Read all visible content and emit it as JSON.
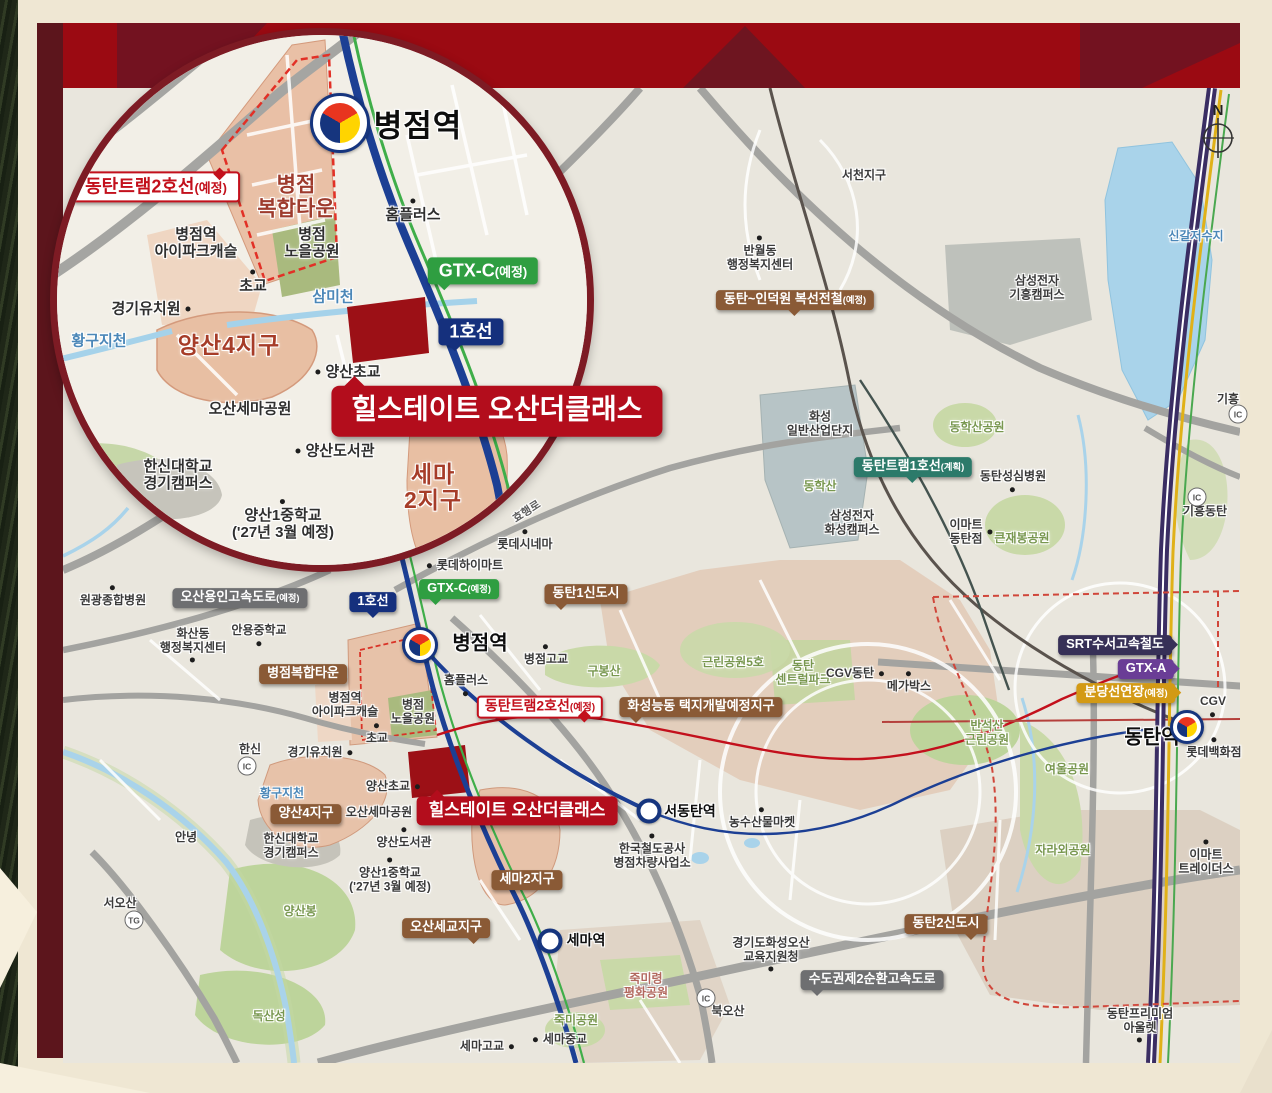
{
  "compass": {
    "north_label": "N"
  },
  "colors": {
    "frame_top": "#9b0a12",
    "frame_left": "#5c151c",
    "margin": "#efe7d3",
    "accent_red": "#b30d1c",
    "line_rail1": "#1c3f94",
    "line_gtxc": "#3fae49",
    "line_srt_gtxa": "#3a2d63",
    "line_bundang": "#e0b118",
    "line_tram2": "#c3101c",
    "badge_brown": "#8a5a36",
    "badge_gray": "#6e6f71",
    "district_salmon": "#e7c2a9",
    "park_green": "#c9d9a8",
    "water_blue": "#a9d3ea",
    "site_red": "#9c1016"
  },
  "callouts": [
    {
      "name": "project-callout-inset",
      "text": "힐스테이트 오산더클래스",
      "type": "callout-red lg",
      "x": 497,
      "y": 411,
      "tail": "tl"
    }
  ],
  "inset": {
    "stations": [
      {
        "name": "byeongjeom-station-symbol-inset",
        "kind": "taegeuk",
        "x": 283,
        "y": 88,
        "size": 54
      }
    ],
    "labels": [
      {
        "name": "station-label-byeongjeom-inset",
        "text": "병점역",
        "type": "station-big",
        "x": 361,
        "y": 91
      },
      {
        "name": "tram2-line-badge-inset",
        "text": "동탄트램2호선",
        "sub": "(예정)",
        "type": "badge-red-outline lg",
        "x": 99,
        "y": 152,
        "tail": "tr"
      },
      {
        "name": "district-byeongjeom-mixed-town",
        "text": "병점\n복합타운",
        "type": "district-text",
        "x": 239,
        "y": 162
      },
      {
        "name": "place-ipark-castle-inset",
        "text": "병점역\n아이파크캐슬",
        "type": "place lg",
        "x": 139,
        "y": 209
      },
      {
        "name": "place-noeul-park-inset",
        "text": "병점\n노을공원",
        "type": "place lg",
        "x": 255,
        "y": 209
      },
      {
        "name": "place-homeplus-inset",
        "text": "홈플러스",
        "type": "place lg",
        "x": 356,
        "y": 181,
        "dot": "t"
      },
      {
        "name": "place-chogyo-inset",
        "text": "초교",
        "type": "place lg",
        "x": 196,
        "y": 252,
        "dot": "t"
      },
      {
        "name": "water-sammicheon-inset",
        "text": "삼미천",
        "type": "water lg",
        "x": 276,
        "y": 263
      },
      {
        "name": "gtxc-badge-inset",
        "text": "GTX-C",
        "sub": "(예정)",
        "type": "badge-green lg",
        "x": 426,
        "y": 236,
        "tail": "bl"
      },
      {
        "name": "line1-badge-inset",
        "text": "1호선",
        "type": "badge-navy lg",
        "x": 414,
        "y": 297,
        "tail": "bl"
      },
      {
        "name": "place-kindergarten-inset",
        "text": "경기유치원",
        "type": "place lg",
        "x": 89,
        "y": 275,
        "dot": "r"
      },
      {
        "name": "water-hwangguji-inset",
        "text": "황구지천",
        "type": "water lg",
        "x": 42,
        "y": 307
      },
      {
        "name": "district-yangsan4-inset",
        "text": "양산4지구",
        "type": "district-big",
        "x": 172,
        "y": 310
      },
      {
        "name": "place-yangsan-elementary-inset",
        "text": "양산초교",
        "type": "place lg",
        "x": 296,
        "y": 338,
        "dot": "l"
      },
      {
        "name": "place-osan-sema-park-inset",
        "text": "오산세마공원",
        "type": "place lg",
        "x": 193,
        "y": 375
      },
      {
        "name": "place-yangsan-library-inset",
        "text": "양산도서관",
        "type": "place lg",
        "x": 283,
        "y": 417,
        "dot": "l"
      },
      {
        "name": "district-sema2-inset",
        "text": "세마\n2지구",
        "type": "district-big",
        "x": 376,
        "y": 452
      },
      {
        "name": "place-hanshin-univ-inset",
        "text": "한신대학교\n경기캠퍼스",
        "type": "place lg",
        "x": 121,
        "y": 441
      },
      {
        "name": "place-namsuwon-inset",
        "text": "남수원\n체력단련장",
        "type": "dim",
        "x": 40,
        "y": 504
      },
      {
        "name": "place-yangsan1-middle-inset",
        "text": "양산1중학교\n('27년 3월 예정)",
        "type": "place lg",
        "x": 226,
        "y": 490,
        "dot": "t"
      }
    ]
  },
  "main": {
    "stations": [
      {
        "name": "byeongjeom-station-symbol",
        "kind": "taegeuk",
        "x": 420,
        "y": 645,
        "size": 30
      },
      {
        "name": "dongtan-station-symbol",
        "kind": "taegeuk",
        "x": 1187,
        "y": 727,
        "size": 28
      },
      {
        "name": "seodongtan-station-symbol",
        "kind": "ring",
        "x": 649,
        "y": 811,
        "size": 17
      },
      {
        "name": "sema-station-symbol",
        "kind": "ring",
        "x": 550,
        "y": 941,
        "size": 17
      }
    ],
    "markers": [
      {
        "name": "ic-giheung",
        "text": "IC",
        "x": 1238,
        "y": 414
      },
      {
        "name": "ic-giheung-dongtan",
        "text": "IC",
        "x": 1197,
        "y": 497
      },
      {
        "name": "ic-hanshin",
        "text": "IC",
        "x": 247,
        "y": 766
      },
      {
        "name": "tg-seoosan",
        "text": "TG",
        "x": 134,
        "y": 920
      },
      {
        "name": "ic-bukosan",
        "text": "IC",
        "x": 706,
        "y": 998
      }
    ],
    "labels": [
      {
        "name": "place-seocheon-district",
        "text": "서천지구",
        "type": "place",
        "x": 864,
        "y": 176
      },
      {
        "name": "place-banwol-center",
        "text": "반월동\n행정복지센터",
        "type": "place",
        "x": 760,
        "y": 258,
        "dot": "t"
      },
      {
        "name": "indeogwon-line-badge",
        "text": "동탄~인덕원 복선전철",
        "sub": "(예정)",
        "type": "badge-brown",
        "x": 795,
        "y": 300,
        "tail": "b"
      },
      {
        "name": "place-samsung-giheung",
        "text": "삼성전자\n기흥캠퍼스",
        "type": "place",
        "x": 1037,
        "y": 288
      },
      {
        "name": "water-singal-reservoir",
        "text": "신갈저수지",
        "type": "water",
        "x": 1196,
        "y": 237
      },
      {
        "name": "place-giheung",
        "text": "기흥",
        "type": "place",
        "x": 1228,
        "y": 400
      },
      {
        "name": "place-hwaseong-industrial",
        "text": "화성\n일반산업단지",
        "type": "place",
        "x": 820,
        "y": 424
      },
      {
        "name": "park-donghaksan-park",
        "text": "동학산공원",
        "type": "park",
        "x": 977,
        "y": 428
      },
      {
        "name": "tram1-line-badge",
        "text": "동탄트램1호선",
        "sub": "(계획)",
        "type": "badge-teal",
        "x": 913,
        "y": 467,
        "tail": "b"
      },
      {
        "name": "place-dongtan-hospital",
        "text": "동탄성심병원",
        "type": "place",
        "x": 1013,
        "y": 477,
        "dot": "b"
      },
      {
        "name": "park-donghaksan",
        "text": "동학산",
        "type": "park",
        "x": 820,
        "y": 487
      },
      {
        "name": "place-giheung-dongtan",
        "text": "기흥동탄",
        "type": "place",
        "x": 1205,
        "y": 512
      },
      {
        "name": "place-samsung-hwaseong",
        "text": "삼성전자\n화성캠퍼스",
        "type": "place",
        "x": 852,
        "y": 523
      },
      {
        "name": "place-emart-dongtan",
        "text": "이마트\n동탄점",
        "type": "place",
        "x": 966,
        "y": 532,
        "dot": "r"
      },
      {
        "name": "park-keunjaebong",
        "text": "큰재봉공원",
        "type": "park",
        "x": 1022,
        "y": 539
      },
      {
        "name": "road-hyohaeng-ro",
        "text": "효행로",
        "type": "road-name",
        "x": 527,
        "y": 512,
        "rot": -33
      },
      {
        "name": "place-lotte-cinema",
        "text": "롯데시네마",
        "type": "place",
        "x": 525,
        "y": 545,
        "dot": "t"
      },
      {
        "name": "place-lotte-himart",
        "text": "롯데하이마트",
        "type": "place",
        "x": 470,
        "y": 566,
        "dot": "l"
      },
      {
        "name": "place-wonkwang-hospital",
        "text": "원광종합병원",
        "type": "place",
        "x": 113,
        "y": 601,
        "dot": "t"
      },
      {
        "name": "osan-yongin-expressway-badge",
        "text": "오산용인고속도로",
        "sub": "(예정)",
        "type": "badge-gray",
        "x": 240,
        "y": 598
      },
      {
        "name": "line1-badge",
        "text": "1호선",
        "type": "badge-navy",
        "x": 373,
        "y": 602,
        "tail": "b"
      },
      {
        "name": "gtxc-badge",
        "text": "GTX-C",
        "sub": "(예정)",
        "type": "badge-green",
        "x": 459,
        "y": 589,
        "tail": "bl"
      },
      {
        "name": "dongtan1-newtown-badge",
        "text": "동탄1신도시",
        "type": "badge-brown",
        "x": 586,
        "y": 594,
        "tail": "bl"
      },
      {
        "name": "place-hwasan-center",
        "text": "화산동\n행정복지센터",
        "type": "place",
        "x": 193,
        "y": 641,
        "dot": "b"
      },
      {
        "name": "place-anyong-middle",
        "text": "안용중학교",
        "type": "place",
        "x": 259,
        "y": 631,
        "dot": "b"
      },
      {
        "name": "station-label-byeongjeom",
        "text": "병점역",
        "type": "station-name",
        "x": 480,
        "y": 644
      },
      {
        "name": "place-byeongjeom-high",
        "text": "병점고교",
        "type": "place",
        "x": 546,
        "y": 660,
        "dot": "t"
      },
      {
        "name": "park-gubongsan",
        "text": "구봉산",
        "type": "park",
        "x": 604,
        "y": 672
      },
      {
        "name": "park-neighborhood5",
        "text": "근린공원5호",
        "type": "park",
        "x": 733,
        "y": 663
      },
      {
        "name": "park-central-park",
        "text": "동탄\n센트럴파크",
        "type": "park",
        "x": 803,
        "y": 673
      },
      {
        "name": "place-cgv-dongtan",
        "text": "CGV동탄",
        "type": "place",
        "x": 850,
        "y": 674,
        "dot": "r"
      },
      {
        "name": "place-megabox",
        "text": "메가박스",
        "type": "place",
        "x": 909,
        "y": 687,
        "dot": "t"
      },
      {
        "name": "byeongjeom-mixed-town-badge",
        "text": "병점복합타운",
        "type": "badge-brown",
        "x": 303,
        "y": 674
      },
      {
        "name": "place-ipark-castle",
        "text": "병점역\n아이파크캐슬",
        "type": "place",
        "x": 345,
        "y": 705
      },
      {
        "name": "place-noeul-park",
        "text": "병점\n노을공원",
        "type": "place",
        "x": 413,
        "y": 712
      },
      {
        "name": "place-homeplus",
        "text": "홈플러스",
        "type": "place",
        "x": 466,
        "y": 681,
        "dot": "b"
      },
      {
        "name": "hwaseong-nungdong-badge",
        "text": "화성능동\n택지개발예정지구",
        "type": "badge-brown",
        "x": 701,
        "y": 707,
        "tail": "bl"
      },
      {
        "name": "tram2-line-badge",
        "text": "동탄트램2호선",
        "sub": "(예정)",
        "type": "badge-red-outline",
        "x": 540,
        "y": 707,
        "tail": "br"
      },
      {
        "name": "srt-badge",
        "text": "SRT수서고속철도",
        "type": "badge-darknavy",
        "x": 1115,
        "y": 645,
        "tail": "r"
      },
      {
        "name": "gtxa-badge",
        "text": "GTX-A",
        "type": "badge-purple",
        "x": 1146,
        "y": 669,
        "tail": "r"
      },
      {
        "name": "bundang-ext-badge",
        "text": "분당선연장",
        "sub": "(예정)",
        "type": "badge-gold",
        "x": 1126,
        "y": 693,
        "tail": "r"
      },
      {
        "name": "place-cgv",
        "text": "CGV",
        "type": "place",
        "x": 1213,
        "y": 702,
        "dot": "b"
      },
      {
        "name": "station-label-dongtan",
        "text": "동탄역",
        "type": "station-name",
        "x": 1152,
        "y": 738
      },
      {
        "name": "place-lotte-dept",
        "text": "롯데백화점",
        "type": "place",
        "x": 1214,
        "y": 753,
        "dot": "t"
      },
      {
        "name": "place-chogyo",
        "text": "초교",
        "type": "place",
        "x": 377,
        "y": 739,
        "dot": "t"
      },
      {
        "name": "place-kindergarten",
        "text": "경기유치원",
        "type": "place",
        "x": 315,
        "y": 753,
        "dot": "r"
      },
      {
        "name": "place-hanshin-ic-label",
        "text": "한신",
        "type": "place",
        "x": 250,
        "y": 750
      },
      {
        "name": "park-banseoksan",
        "text": "반석산\n근린공원",
        "type": "park",
        "x": 987,
        "y": 733
      },
      {
        "name": "park-yeoul",
        "text": "여울공원",
        "type": "park",
        "x": 1067,
        "y": 770
      },
      {
        "name": "water-hwangguji",
        "text": "황구지천",
        "type": "water",
        "x": 282,
        "y": 794
      },
      {
        "name": "yangsan4-badge",
        "text": "양산4지구",
        "type": "badge-brown",
        "x": 306,
        "y": 814
      },
      {
        "name": "place-yangsan-elementary",
        "text": "양산초교",
        "type": "place",
        "x": 388,
        "y": 787,
        "dot": "r"
      },
      {
        "name": "place-osan-sema-park",
        "text": "오산세마공원",
        "type": "place",
        "x": 379,
        "y": 813
      },
      {
        "name": "project-callout-main",
        "text": "힐스테이트 오산더클래스",
        "type": "callout-red",
        "x": 517,
        "y": 811,
        "tail": "tl"
      },
      {
        "name": "station-label-seodongtan",
        "text": "서동탄역",
        "type": "station-name sm",
        "x": 690,
        "y": 812
      },
      {
        "name": "place-farm-market",
        "text": "농수산물마켓",
        "type": "place",
        "x": 762,
        "y": 823,
        "dot": "t"
      },
      {
        "name": "place-annyeong",
        "text": "안녕",
        "type": "place",
        "x": 186,
        "y": 838
      },
      {
        "name": "place-hanshin-univ",
        "text": "한신대학교\n경기캠퍼스",
        "type": "place",
        "x": 291,
        "y": 846
      },
      {
        "name": "place-yangsan-library",
        "text": "양산도서관",
        "type": "place",
        "x": 404,
        "y": 843,
        "dot": "t"
      },
      {
        "name": "place-korail-depot",
        "text": "한국철도공사\n병점차량사업소",
        "type": "place",
        "x": 652,
        "y": 856,
        "dot": "t"
      },
      {
        "name": "sema2-badge",
        "text": "세마2지구",
        "type": "badge-brown",
        "x": 527,
        "y": 880
      },
      {
        "name": "place-yangsan1-middle",
        "text": "양산1중학교\n('27년 3월 예정)",
        "type": "place",
        "x": 390,
        "y": 880,
        "dot": "t"
      },
      {
        "name": "park-jaraoe",
        "text": "자라외공원",
        "type": "park",
        "x": 1063,
        "y": 851
      },
      {
        "name": "place-emart-traders",
        "text": "이마트\n트레이더스",
        "type": "place",
        "x": 1206,
        "y": 862,
        "dot": "t"
      },
      {
        "name": "park-yangsanbong",
        "text": "양산봉",
        "type": "park",
        "x": 300,
        "y": 912
      },
      {
        "name": "place-seoosan",
        "text": "서오산",
        "type": "place",
        "x": 120,
        "y": 904
      },
      {
        "name": "osan-segyo-badge",
        "text": "오산세교지구",
        "type": "badge-brown",
        "x": 446,
        "y": 928,
        "tail": "br"
      },
      {
        "name": "dongtan2-newtown-badge",
        "text": "동탄2신도시",
        "type": "badge-brown",
        "x": 946,
        "y": 924,
        "tail": "br"
      },
      {
        "name": "station-label-sema",
        "text": "세마역",
        "type": "station-name sm",
        "x": 586,
        "y": 941
      },
      {
        "name": "place-education-office",
        "text": "경기도화성오산\n교육지원청",
        "type": "place",
        "x": 771,
        "y": 950,
        "dot": "b"
      },
      {
        "name": "ring2-expressway-badge",
        "text": "수도권제2순환고속도로",
        "type": "badge-gray",
        "x": 872,
        "y": 980,
        "tail": "bl"
      },
      {
        "name": "park-jukmiryeong",
        "text": "죽미령\n평화공원",
        "type": "park-red",
        "x": 646,
        "y": 986
      },
      {
        "name": "park-doksanseong",
        "text": "독산성",
        "type": "park",
        "x": 269,
        "y": 1017
      },
      {
        "name": "park-jukmi",
        "text": "죽미공원",
        "type": "park",
        "x": 576,
        "y": 1021
      },
      {
        "name": "place-bukosan",
        "text": "북오산",
        "type": "place",
        "x": 728,
        "y": 1012
      },
      {
        "name": "place-sema-high",
        "text": "세마고교",
        "type": "place",
        "x": 482,
        "y": 1047,
        "dot": "r"
      },
      {
        "name": "place-sema-middle",
        "text": "세마중교",
        "type": "place",
        "x": 565,
        "y": 1040,
        "dot": "l"
      },
      {
        "name": "place-dongtan-premium-outlet",
        "text": "동탄프리미엄\n아울렛",
        "type": "place",
        "x": 1140,
        "y": 1021,
        "dot": "b"
      }
    ]
  }
}
